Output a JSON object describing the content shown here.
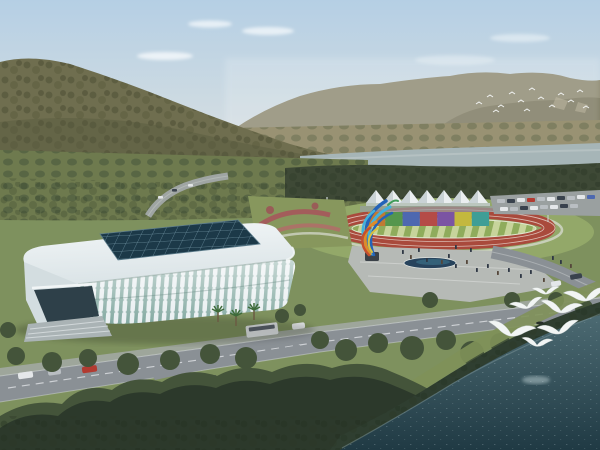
{
  "scene": {
    "type": "architectural-aerial-rendering",
    "description": "Aerial rendering of a riverside sports complex: a white lattice gymnasium with blue glass skylight roof, an athletics track with rainbow banner wall and white peaked canopy tents, a colorful flame sculpture, plazas with pedestrians, tree-lined boulevards with vehicles, forested mountains and a river behind, dark water with white gulls in the foreground",
    "objects": [
      "sky",
      "clouds",
      "distant-mountains",
      "forested-hill",
      "valley-fields",
      "river",
      "treeline",
      "orchard-rows",
      "gymnasium",
      "skylight-roof",
      "athletics-track",
      "striped-infield",
      "rainbow-wall",
      "canopy-tents",
      "parking-lot",
      "flame-sculpture",
      "flower-garden",
      "plaza",
      "pond",
      "pedestrians",
      "roads",
      "vehicles",
      "palm-trees",
      "roadside-trees",
      "foreground-forest",
      "shoreline",
      "water",
      "gulls",
      "distant-bird-flock"
    ]
  },
  "palette": {
    "sky_top": "#b5cfe4",
    "sky_horizon": "#eae8e0",
    "cloud_white": "#fafcfd",
    "hill_green": "#6f6e4f",
    "mountain_far": "#8e8a72",
    "mountain_near": "#7b785f",
    "valley_field": "#999273",
    "river": "#a6b5b7",
    "treeline_dark": "#3e4936",
    "ground_green": "#7e915e",
    "lawn_light": "#93a869",
    "track_red": "#a94a3c",
    "field_light": "#c7d49b",
    "field_dark": "#8fac5c",
    "tent_white": "#eaeef0",
    "tent_shade": "#c9d2d5",
    "parking_gray": "#9aa0a0",
    "plaza_gray": "#b6bab6",
    "pond_blue": "#27435c",
    "roof_white": "#dbe4e7",
    "skylight_blue": "#1c3948",
    "skylight_grid": "#7fa3b2",
    "rib_white": "#e9eff1",
    "glass_teal": "#84aaa2",
    "entrance_glass": "#2e4049",
    "stair_gray": "#aab3b5",
    "road_gray": "#8a9095",
    "lane_white": "#d9dde0",
    "tree_mid": "#44543a",
    "tree_dark": "#2c392b",
    "water_light": "#4c6a72",
    "water_dark": "#203a44",
    "gull_white": "#f2f5f4"
  },
  "track": {
    "rainbow_panels": [
      "#bf7a33",
      "#55964d",
      "#4d68b0",
      "#b54b47",
      "#7b54a3",
      "#c3b83e",
      "#3f9e96"
    ]
  },
  "sculpture": {
    "blue": "#2463b8",
    "light_blue": "#43b1dc",
    "orange": "#dd8c2a",
    "red": "#c44f2e",
    "yellow": "#d9c13e",
    "green": "#3f9c58"
  },
  "vehicles": {
    "bus": "#dfe3e4",
    "red_car": "#b23b31",
    "white_car": "#e4e7e9",
    "silver_car": "#b9bec2",
    "dark_car": "#39424d"
  },
  "counts": {
    "canopy_tents": 7,
    "rainbow_panels": 7,
    "gulls_foreground": 7,
    "distant_flock_birds": 14
  }
}
